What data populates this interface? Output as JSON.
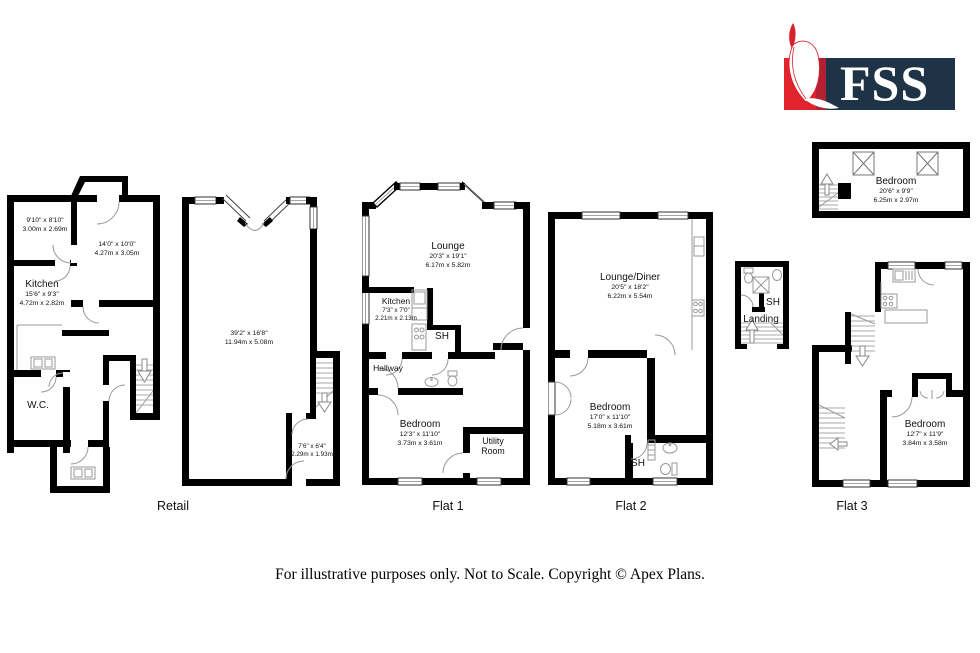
{
  "logo": {
    "brand": "FSS"
  },
  "footer": {
    "disclaimer": "For illustrative purposes only. Not to Scale. Copyright © Apex Plans."
  },
  "plans": {
    "ground": {
      "room_top_left": {
        "ft": "9'10\" x 8'10\"",
        "m": "3.00m x 2.69m"
      },
      "room_top_right": {
        "ft": "14'0\" x 10'0\"",
        "m": "4.27m x 3.05m"
      },
      "kitchen": {
        "name": "Kitchen",
        "ft": "15'6\" x 9'3\"",
        "m": "4.72m x 2.82m"
      },
      "wc": {
        "name": "W.C."
      }
    },
    "retail": {
      "label": "Retail",
      "main": {
        "ft": "39'2\" x 16'8\"",
        "m": "11.94m x 5.08m"
      },
      "store": {
        "ft": "7'6\" x 6'4\"",
        "m": "2.29m x 1.93m"
      }
    },
    "flat1": {
      "label": "Flat 1",
      "lounge": {
        "name": "Lounge",
        "ft": "20'3\" x 19'1\"",
        "m": "6.17m x 5.82m"
      },
      "kitchen": {
        "name": "Kitchen",
        "ft": "7'3\" x 7'0\"",
        "m": "2.21m x 2.13m"
      },
      "sh": {
        "name": "SH"
      },
      "hallway": {
        "name": "Hallway"
      },
      "bedroom": {
        "name": "Bedroom",
        "ft": "12'3\" x 11'10\"",
        "m": "3.73m x 3.61m"
      },
      "utility": {
        "name": "Utility Room"
      }
    },
    "flat2": {
      "label": "Flat 2",
      "lounge_diner": {
        "name": "Lounge/Diner",
        "ft": "20'5\" x 18'2\"",
        "m": "6.22m x 5.54m"
      },
      "bedroom": {
        "name": "Bedroom",
        "ft": "17'0\" x 11'10\"",
        "m": "5.18m x 3.61m"
      },
      "sh": {
        "name": "SH"
      }
    },
    "landing": {
      "sh": {
        "name": "SH"
      },
      "landing": {
        "name": "Landing"
      }
    },
    "attic": {
      "bedroom": {
        "name": "Bedroom",
        "ft": "20'6\" x 9'9\"",
        "m": "6.25m x 2.97m"
      }
    },
    "flat3": {
      "label": "Flat 3",
      "bedroom": {
        "name": "Bedroom",
        "ft": "12'7\" x 11'9\"",
        "m": "3.84m x 3.58m"
      }
    }
  }
}
